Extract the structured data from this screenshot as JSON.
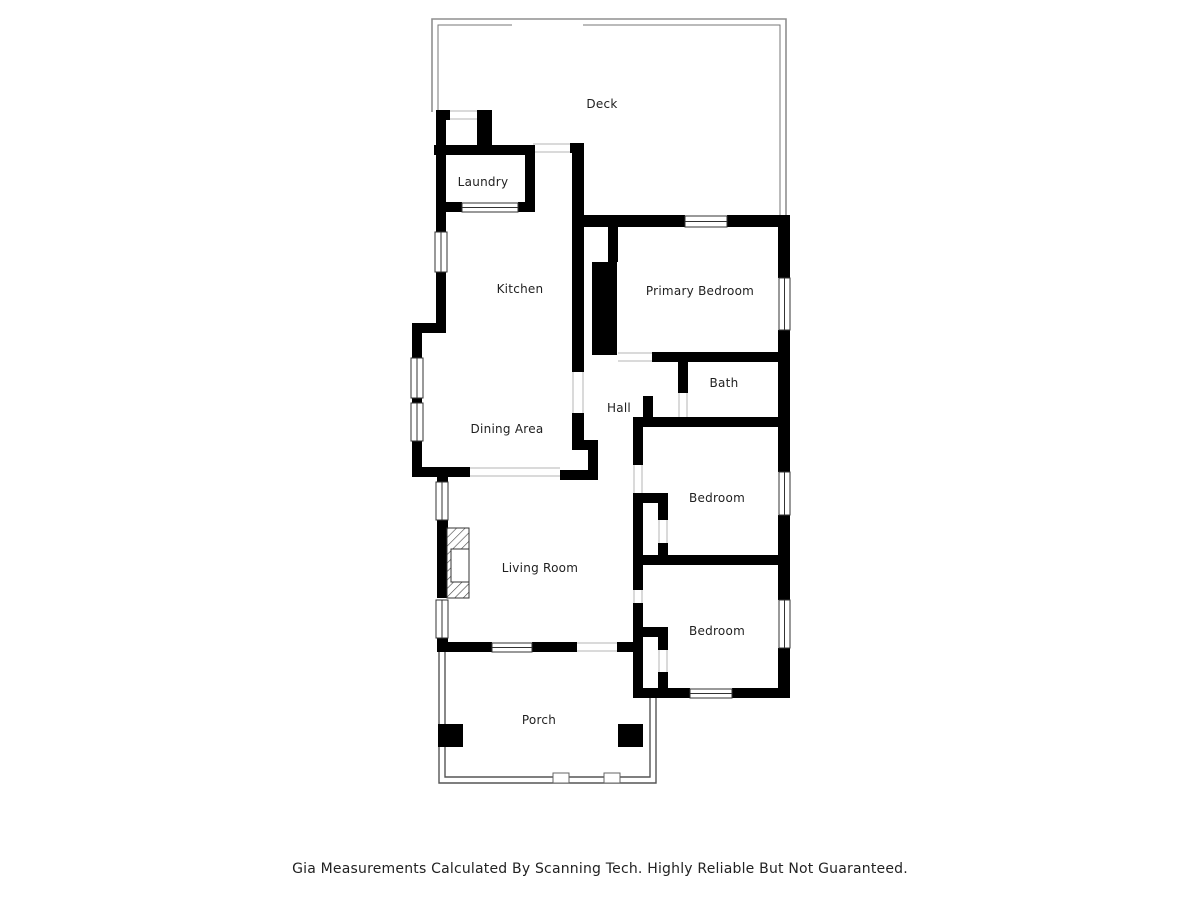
{
  "rooms": {
    "deck": "Deck",
    "laundry": "Laundry",
    "kitchen": "Kitchen",
    "primary_bedroom": "Primary Bedroom",
    "bath": "Bath",
    "hall": "Hall",
    "dining_area": "Dining Area",
    "living_room": "Living Room",
    "bedroom_middle": "Bedroom",
    "bedroom_bottom": "Bedroom",
    "porch": "Porch"
  },
  "footer": {
    "disclaimer": "Gia Measurements Calculated By Scanning Tech. Highly Reliable But Not Guaranteed."
  },
  "features": {
    "fireplace": "fireplace",
    "chimney": "chimney-block",
    "porch_posts": "porch-posts",
    "windows": "window-openings"
  },
  "colors": {
    "walls": "#000000",
    "deck_outline": "#8f8f8f",
    "porch_outline": "#555555",
    "label_text": "#1f1f1f",
    "background": "#ffffff"
  }
}
